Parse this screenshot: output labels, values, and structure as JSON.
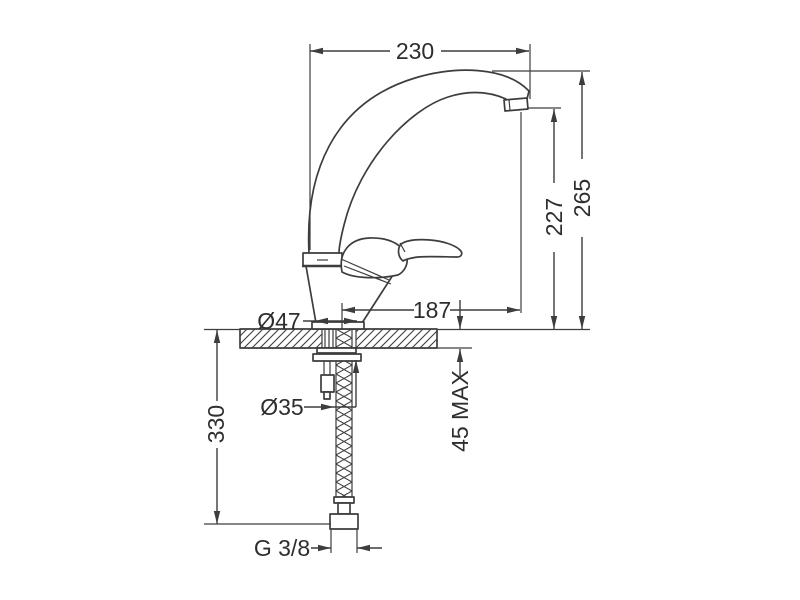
{
  "drawing": {
    "kind": "technical-dimension-drawing",
    "background_color": "#ffffff",
    "line_color": "#3d3d3d",
    "text_color": "#2e2e2e",
    "labels": {
      "spout_reach": "230",
      "overall_height": "265",
      "outlet_height": "227",
      "outlet_reach": "187",
      "base_diameter": "Ø47",
      "hole_diameter": "Ø35",
      "hose_length": "330",
      "max_deck_thickness": "45 MAX",
      "thread_size": "G 3/8"
    }
  }
}
